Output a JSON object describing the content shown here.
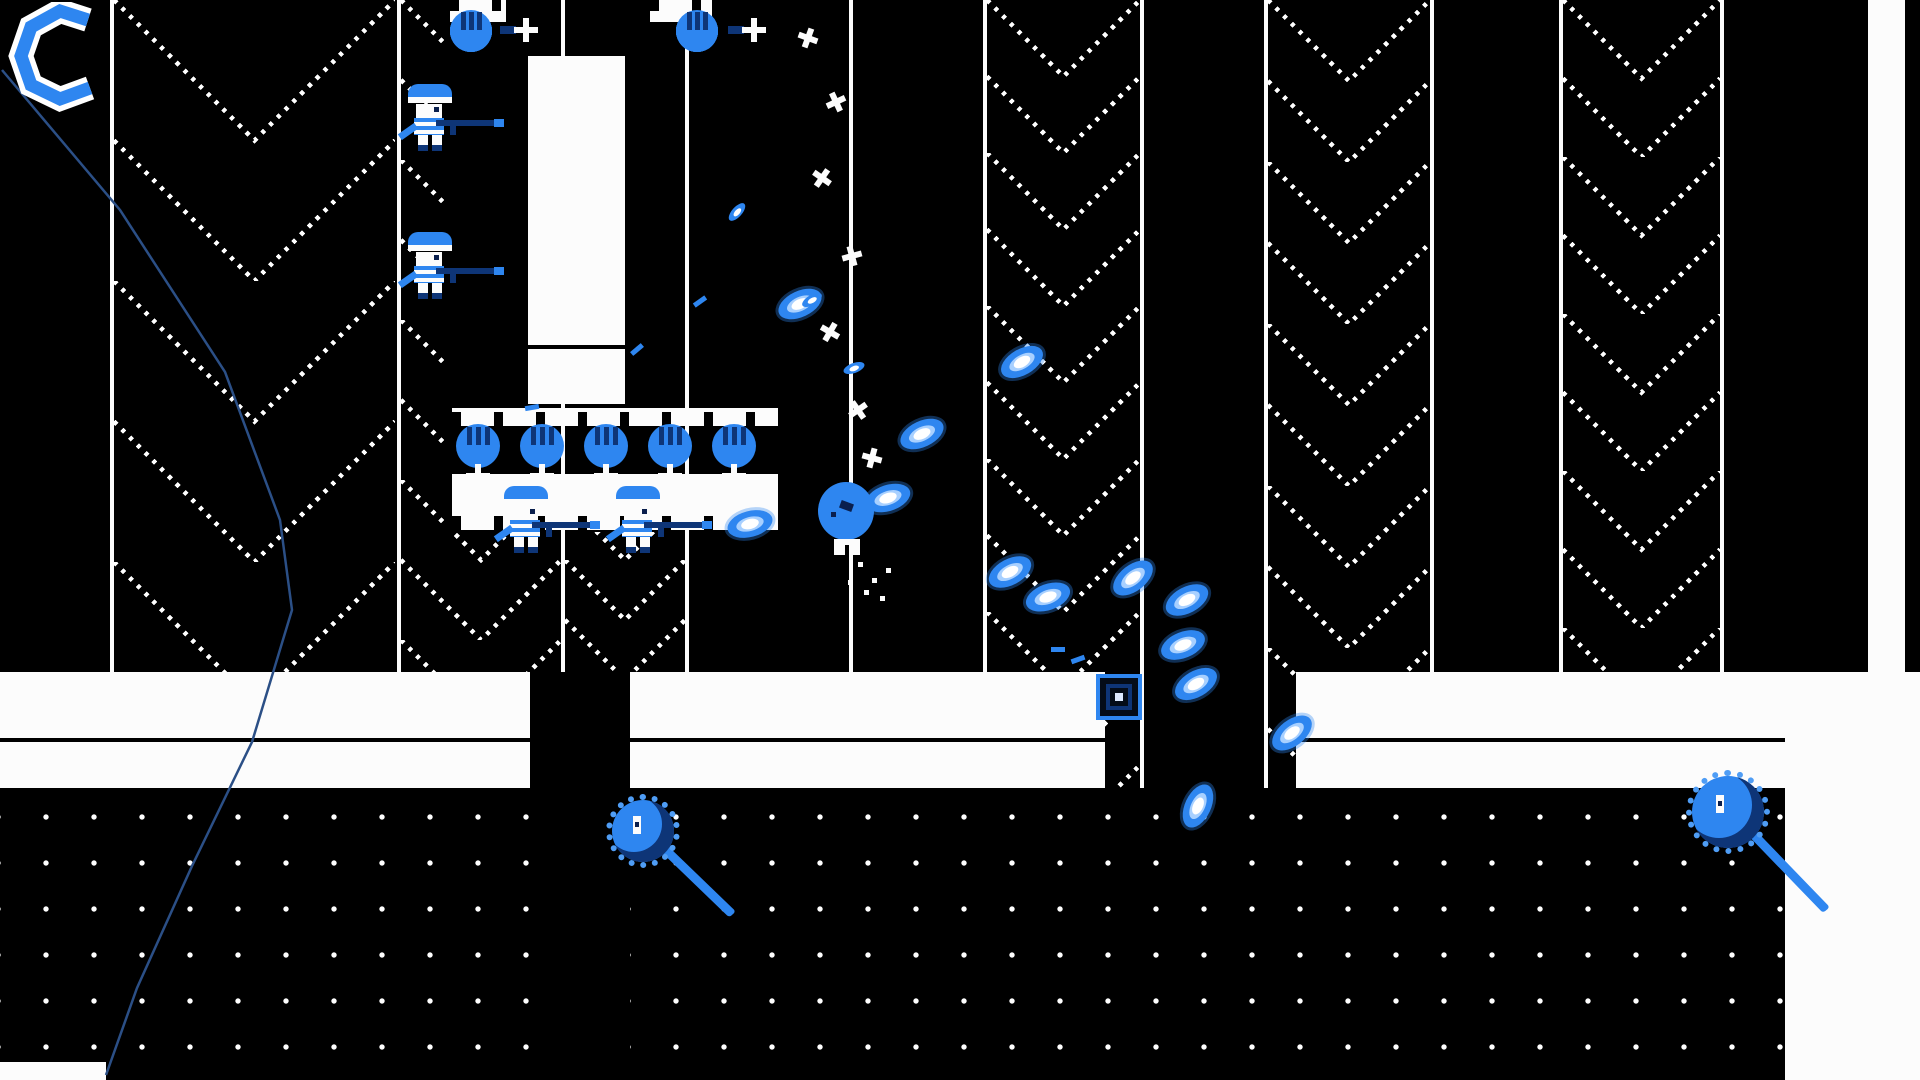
{
  "palette": {
    "bg": "#000000",
    "white": "#fcfcfc",
    "blue": "#2e86f0",
    "blue_light": "#a8d0ff",
    "blue_mid": "#4f9df5",
    "blue_dark": "#0e3577",
    "navy": "#0a1f4d",
    "wire": "#2b4f86",
    "block_fill": "#040c18"
  },
  "hud": {
    "charge_ring_points": "80,18 52,9 23,25 13,54 23,83 52,97 82,86",
    "pos": [
      8,
      2
    ]
  },
  "world": {
    "vlines": [
      [
        110,
        672
      ],
      [
        397,
        672
      ],
      [
        561,
        672
      ],
      [
        685,
        672
      ],
      [
        849,
        672
      ],
      [
        983,
        788
      ],
      [
        1140,
        788
      ],
      [
        1264,
        788
      ],
      [
        1430,
        672
      ],
      [
        1559,
        672
      ],
      [
        1720,
        672
      ]
    ],
    "chevron_strips": [
      [
        114,
        281,
        0,
        672
      ],
      [
        401,
        160,
        0,
        672
      ],
      [
        565,
        120,
        440,
        672
      ],
      [
        987,
        153,
        0,
        788
      ],
      [
        1268,
        162,
        0,
        788
      ],
      [
        1563,
        157,
        0,
        672
      ]
    ],
    "white_strip_right": [
      1868,
      37,
      0,
      672
    ],
    "fort_backing": [
      446,
      0,
      340,
      532
    ]
  },
  "platforms": {
    "band_segments": [
      [
        0,
        530
      ],
      [
        630,
        475
      ],
      [
        1296,
        624
      ]
    ],
    "band_top_y": 672,
    "band_top_h": 66,
    "seam_y": 738,
    "seam_h": 4,
    "band2_y": 742,
    "band2_h": 46,
    "floor_segments": [
      [
        0,
        530
      ],
      [
        630,
        1155
      ]
    ],
    "floor_y": 788,
    "floor_h": 292,
    "white_block_right": [
      1785,
      672,
      135,
      408
    ],
    "corner_white_bottom_left": [
      0,
      1062,
      106,
      18
    ]
  },
  "fort": {
    "left_column": {
      "x": 450,
      "start_y": -6,
      "units": 9,
      "step": 48,
      "block_w": 56,
      "circle_off": 0,
      "prong_x": 50
    },
    "right_column": {
      "x": 650,
      "start_y": -6,
      "units": 9,
      "step": 48,
      "block_w": 62,
      "circle_off": 26,
      "prong_x": 78
    },
    "unit_h": 48,
    "circle_d": 42,
    "interior_blocks": [
      [
        528,
        56,
        97,
        289
      ],
      [
        528,
        349,
        97,
        55
      ]
    ],
    "interior_seam": [
      528,
      345,
      97,
      4
    ],
    "bottom_bar": [
      452,
      408,
      326,
      18
    ],
    "bottom_cannons": {
      "y": 424,
      "xs": [
        478,
        542,
        606,
        670,
        734
      ]
    },
    "castle_strip": [
      452,
      474,
      326,
      56
    ]
  },
  "soldiers": [
    [
      406,
      84
    ],
    [
      406,
      232
    ],
    [
      502,
      486
    ],
    [
      614,
      486
    ]
  ],
  "enemies": {
    "balloon": [
      818,
      482
    ],
    "block": [
      1096,
      674
    ],
    "snails": [
      [
        606,
        794,
        74,
        42
      ],
      [
        1686,
        770,
        84,
        40
      ]
    ]
  },
  "projectiles": {
    "large": [
      [
        800,
        304,
        -25
      ],
      [
        1022,
        362,
        -30
      ],
      [
        922,
        434,
        -25
      ],
      [
        888,
        498,
        -18
      ],
      [
        750,
        524,
        -15
      ],
      [
        1010,
        572,
        -28
      ],
      [
        1048,
        597,
        -20
      ],
      [
        1133,
        578,
        -38
      ],
      [
        1187,
        600,
        -28
      ],
      [
        1183,
        645,
        -22
      ],
      [
        1196,
        684,
        -30
      ],
      [
        1292,
        733,
        -38
      ],
      [
        1198,
        806,
        -65
      ]
    ],
    "small": [
      [
        737,
        212,
        -48
      ],
      [
        854,
        368,
        -20
      ],
      [
        812,
        300,
        -30
      ]
    ],
    "dashes": [
      [
        637,
        350,
        -40
      ],
      [
        532,
        408,
        -10
      ],
      [
        1078,
        660,
        -20
      ],
      [
        1058,
        650,
        0
      ],
      [
        700,
        302,
        -35
      ]
    ]
  },
  "debris_crosses": [
    [
      798,
      28,
      20
    ],
    [
      826,
      92,
      -25
    ],
    [
      812,
      168,
      35
    ],
    [
      842,
      246,
      -15
    ],
    [
      820,
      322,
      30
    ],
    [
      848,
      400,
      -35
    ],
    [
      862,
      448,
      15
    ]
  ],
  "wire_points": "2,70 120,210 225,372 280,520 292,610 252,742 192,866 137,988 106,1075"
}
